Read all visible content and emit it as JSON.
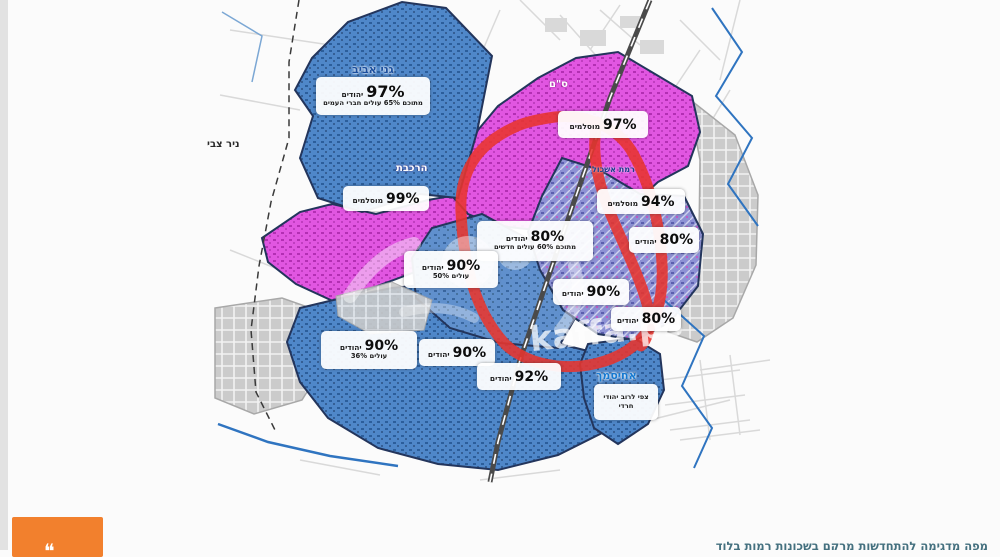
{
  "page": {
    "caption": "מפה מדגימה להתחדשות מרקם בשכונות רמות בלוד",
    "watermark": "kaffa.ps",
    "quote_mark": "❝"
  },
  "map": {
    "place_names": {
      "gani_aviv": "גני אביב",
      "nir_tzvi": "ניר צבי",
      "harakevet": "הרכבת",
      "sam": "ס\"ם",
      "ramat_eshkol": "רמת אשכול",
      "ahisamakh": "אחיסמך"
    },
    "stat_labels": [
      {
        "pct": "97%",
        "group": "יהודים",
        "note": "מתוכם 65% עולים חברי העמים"
      },
      {
        "pct": "99%",
        "group": "מוסלמים",
        "note": ""
      },
      {
        "pct": "97%",
        "group": "מוסלמים",
        "note": ""
      },
      {
        "pct": "94%",
        "group": "מוסלמים",
        "note": ""
      },
      {
        "pct": "80%",
        "group": "יהודים",
        "note": "מתוכם 60% עולים חדשים"
      },
      {
        "pct": "80%",
        "group": "יהודים",
        "note": ""
      },
      {
        "pct": "90%",
        "group": "יהודים",
        "note": "עולים 50%"
      },
      {
        "pct": "90%",
        "group": "יהודים",
        "note": ""
      },
      {
        "pct": "80%",
        "group": "יהודים",
        "note": ""
      },
      {
        "pct": "90%",
        "group": "יהודים",
        "note": "עולים 36%"
      },
      {
        "pct": "90%",
        "group": "יהודים",
        "note": ""
      },
      {
        "pct": "92%",
        "group": "יהודים",
        "note": ""
      },
      {
        "pct": "",
        "group": "",
        "note": "צפי לרוב יהודי חרדי"
      }
    ],
    "colors": {
      "jewish_area": "#4f87c9",
      "arab_area": "#df5bdf",
      "mixed_area": "#8a8ed2",
      "annotation_red": "#e8352e",
      "accent_orange": "#f2802d"
    }
  }
}
